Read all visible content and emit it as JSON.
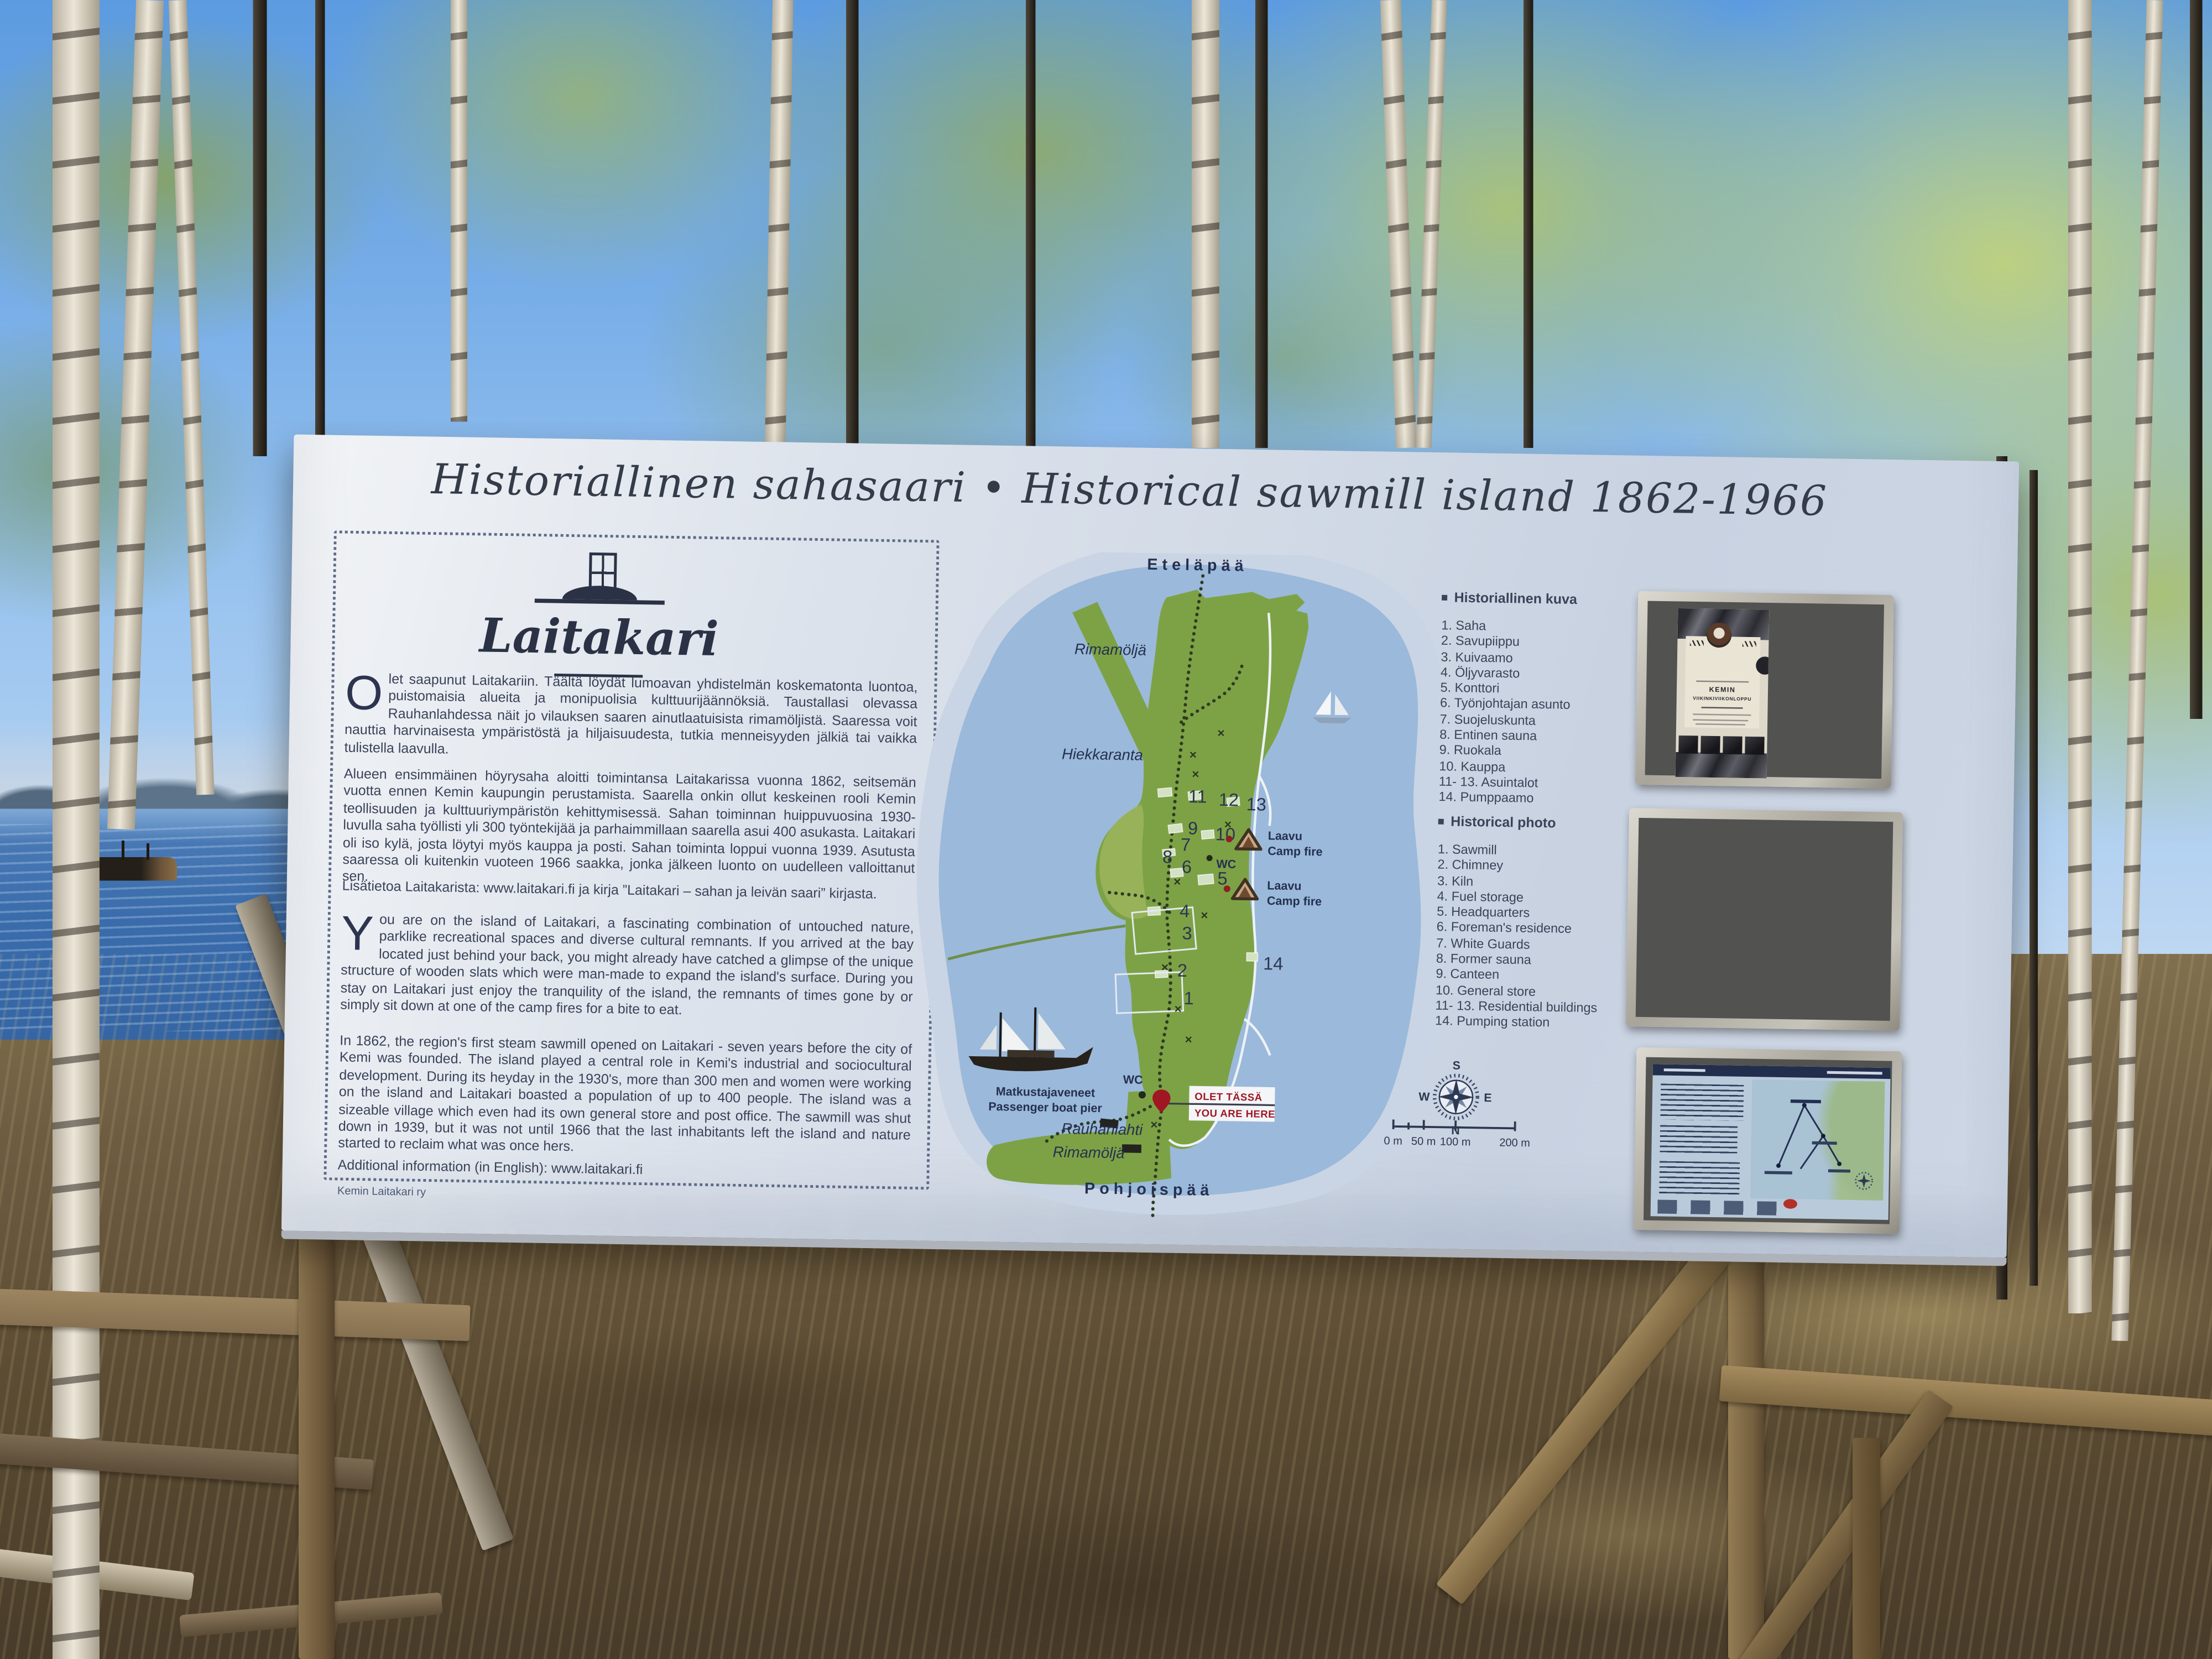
{
  "sign": {
    "title": "Historiallinen sahasaari • Historical sawmill island 1862-1966",
    "logo_name": "Laitakari",
    "intro_fi": {
      "dropcap": "O",
      "text": "let saapunut Laitakariin. Täältä löydät lumoavan yhdistelmän koskematonta luontoa, puistomaisia alueita ja monipuolisia kulttuurijäännöksiä. Taustallasi olevassa Rauhanlahdessa näit jo vilauksen saaren ainutlaatuisista rimamöljistä. Saaressa voit nauttia harvinaisesta ympäristöstä ja hiljaisuudesta, tutkia menneisyyden jälkiä tai vaikka tulistella laavulla."
    },
    "history_fi": "Alueen ensimmäinen höyrysaha aloitti toimintansa Laitakarissa vuonna 1862, seitsemän vuotta ennen Kemin kaupungin perustamista. Saarella onkin ollut keskeinen rooli Kemin teollisuuden ja kulttuuriympäristön kehittymisessä. Sahan toiminnan huippuvuosina 1930-luvulla saha työllisti yli 300 työntekijää ja parhaimmillaan saarella asui 400 asukasta. Laitakari oli iso kylä, josta löytyi myös kauppa ja posti. Sahan toiminta loppui vuonna 1939. Asutusta saaressa oli kuitenkin vuoteen 1966 saakka, jonka jälkeen luonto on uudelleen valloittanut sen.",
    "more_info_fi": "Lisätietoa Laitakarista: www.laitakari.fi ja kirja ”Laitakari – sahan ja leivän saari” kirjasta.",
    "intro_en": {
      "dropcap": "Y",
      "text": "ou are on the island of Laitakari, a fascinating combination of untouched nature, parklike recreational spaces and diverse cultural remnants. If you arrived at the bay located just behind your back, you might already have catched a glimpse of the unique structure of wooden slats which were man-made to expand the island's surface. During you stay on Laitakari just enjoy the tranquility of the island, the remnants of times gone by or simply sit down at one of the camp fires for a bite to eat."
    },
    "history_en": "In 1862, the region's first steam sawmill opened on Laitakari - seven years before the city of Kemi was founded. The island played a central role in Kemi's industrial and sociocultural development. During its heyday in the 1930's, more than 300 men and women were working on the island and Laitakari boasted a population of up to 400 people. The island was a sizeable village which even had its own general store and post office. The sawmill was shut down in 1939, but it was not until 1966 that the last inhabitants left the island and nature started to reclaim what was once hers.",
    "more_info_en": "Additional information (in English): www.laitakari.fi",
    "credit": "Kemin Laitakari ry"
  },
  "legend_fi": {
    "title": "Historiallinen kuva",
    "items": [
      "1. Saha",
      "2. Savupiippu",
      "3. Kuivaamo",
      "4. Öljyvarasto",
      "5. Konttori",
      "6. Työnjohtajan asunto",
      "7. Suojeluskunta",
      "8. Entinen sauna",
      "9. Ruokala",
      "10. Kauppa",
      "11- 13. Asuintalot",
      "14. Pumppaamo"
    ]
  },
  "legend_en": {
    "title": "Historical photo",
    "items": [
      "1. Sawmill",
      "2. Chimney",
      "3. Kiln",
      "4. Fuel storage",
      "5. Headquarters",
      "6. Foreman's residence",
      "7. White Guards",
      "8. Former sauna",
      "9. Canteen",
      "10. General store",
      "11- 13. Residential buildings",
      "14. Pumping station"
    ]
  },
  "map": {
    "labels": {
      "south_end": "Eteläpää",
      "rimamolja_upper": "Rimamöljä",
      "beach": "Hiekkaranta",
      "bay": "Rauhanlahti",
      "rimamolja_lower": "Rimamöljä",
      "north_end": "Pohjoispää"
    },
    "wc": "WC",
    "laavu_title": "Laavu",
    "laavu_sub": "Camp fire",
    "you_are_here": {
      "fi": "OLET TÄSSÄ",
      "en": "YOU ARE HERE"
    },
    "pier": {
      "fi": "Matkustajaveneet",
      "en": "Passenger boat pier"
    },
    "numbers": [
      "11",
      "12",
      "13",
      "9",
      "10",
      "7",
      "8",
      "6",
      "5",
      "4",
      "3",
      "2",
      "1",
      "14"
    ],
    "scale": [
      "0 m",
      "50 m",
      "100 m",
      "200 m"
    ],
    "compass": {
      "top": "S",
      "bottom": "N",
      "left": "W",
      "right": "E"
    }
  },
  "poster": {
    "heading_line1": "KEMIN",
    "heading_line2": "VIIKINKIVIIKONLOPPU"
  },
  "colors": {
    "sign_background": "#d8dfe9",
    "navy_text": "#2e3a54",
    "island_green": "#7da245",
    "water_blue": "#9bb9da",
    "accent_red": "#a01622",
    "wood_brown": "#84704e"
  }
}
